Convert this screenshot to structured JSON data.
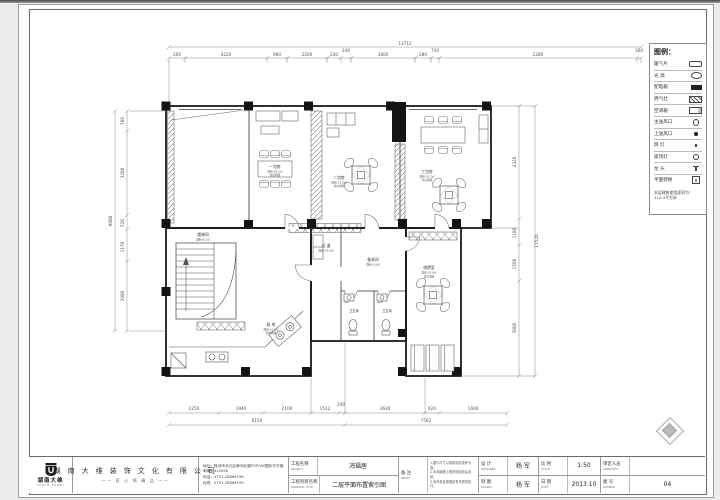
{
  "legend": {
    "title": "图例：",
    "items": [
      {
        "label": "暖气片",
        "symbol": "radiator-icon"
      },
      {
        "label": "光 源",
        "symbol": "light-icon"
      },
      {
        "label": "配电箱",
        "symbol": "distribution-box-icon"
      },
      {
        "label": "燃气灶",
        "symbol": "gas-stove-icon"
      },
      {
        "label": "空调箱",
        "symbol": "ac-unit-icon"
      },
      {
        "label": "主送风口",
        "symbol": "supply-vent-icon"
      },
      {
        "label": "上送风口",
        "symbol": "top-vent-icon"
      },
      {
        "label": "筒 灯",
        "symbol": "downlight-icon"
      },
      {
        "label": "吸顶灯",
        "symbol": "ceiling-lamp-icon"
      },
      {
        "label": "龙 头",
        "symbol": "faucet-icon"
      },
      {
        "label": "平面转换",
        "symbol": "plan-symbol-icon"
      }
    ],
    "note": "本层建筑使用面积为：112.4平方米"
  },
  "plan": {
    "rooms": [
      {
        "name": "一包房",
        "area": "面积:26.5㎡",
        "finish": "仿古地砖"
      },
      {
        "name": "二包房",
        "area": "面积:22.8㎡",
        "finish": "仿古地砖"
      },
      {
        "name": "三包房",
        "area": "面积:30.2㎡",
        "finish": "仿古地砖"
      },
      {
        "name": "过 道",
        "area": "面积:18.6㎡",
        "finish": "仿古地砖"
      },
      {
        "name": "楼梯间",
        "area": "面积:8.2㎡",
        "finish": "花岗岩"
      },
      {
        "name": "厨 房",
        "area": "面积:15.3㎡",
        "finish": "防滑地砖"
      },
      {
        "name": "备餐间",
        "area": "面积:6.8㎡",
        "finish": "防滑地砖"
      },
      {
        "name": "卫生间",
        "area": "面积:4.2㎡",
        "finish": "防滑地砖"
      },
      {
        "name": "卫生间",
        "area": "面积:4.2㎡",
        "finish": "防滑地砖"
      },
      {
        "name": "棋牌室",
        "area": "面积:24.6㎡",
        "finish": "仿古地砖"
      }
    ]
  },
  "dims": {
    "top_total": "13712",
    "top": [
      "200",
      "4220",
      "980",
      "2200",
      "230",
      "240",
      "3600",
      "280",
      "730",
      "2280",
      "360"
    ],
    "left_total": "9080",
    "left": [
      "780",
      "3200",
      "520",
      "1170",
      "2080"
    ],
    "right_total": "11520",
    "right": [
      "4320",
      "1180",
      "1560",
      "3000"
    ],
    "bottom": [
      "2250",
      "1940",
      "2100",
      "1512",
      "240",
      "3630",
      "620",
      "1600"
    ],
    "bottom_totals": [
      "6150",
      "7562"
    ]
  },
  "titleblock": {
    "logo": {
      "name": "湖南大维",
      "sub": "HUNAN DAWEI"
    },
    "company": {
      "name": "湖 南 大 维 装 饰 文 化 有 限 公 司",
      "slogan": "—— 匠 心 铸 精 品 ——"
    },
    "contact": {
      "address": "地址：株洲市天元区黄河北路POPOW国际写字楼4楼",
      "postal": "邮编：412000",
      "phone": "电话：0731-28869158",
      "fax": "传真：0731-28869159"
    },
    "fields": {
      "project_cn": "工程名称",
      "project_en": "PROJECT",
      "project_value": "鸿福居",
      "drawing_cn": "工程项目名称",
      "drawing_en": "DRAWING TITLE",
      "drawing_value": "二层平面布置索引图",
      "memo_cn": "备 注",
      "memo_en": "MEMO",
      "memo_text": "1.图中尺寸以现场实际放样为准；\n2.水电隐蔽工程须经验收后封闭；\n3.未尽事宜按国家有关规范执行。",
      "designer_cn": "设 计",
      "designer_en": "DESIGNER",
      "designer_value": "杨 军",
      "drawer_cn": "制 图",
      "drawer_en": "DRAWN",
      "drawer_value": "杨 军",
      "scale_cn": "比 例",
      "scale_en": "SCALE",
      "scale_value": "1:50",
      "date_cn": "日 期",
      "date_en": "DATE",
      "date_value": "2013.10",
      "approved_cn": "审定人员",
      "approved_en": "APPROVED",
      "approved_value": "",
      "number_cn": "图 号",
      "number_en": "NUMBER",
      "number_value": "04"
    }
  }
}
